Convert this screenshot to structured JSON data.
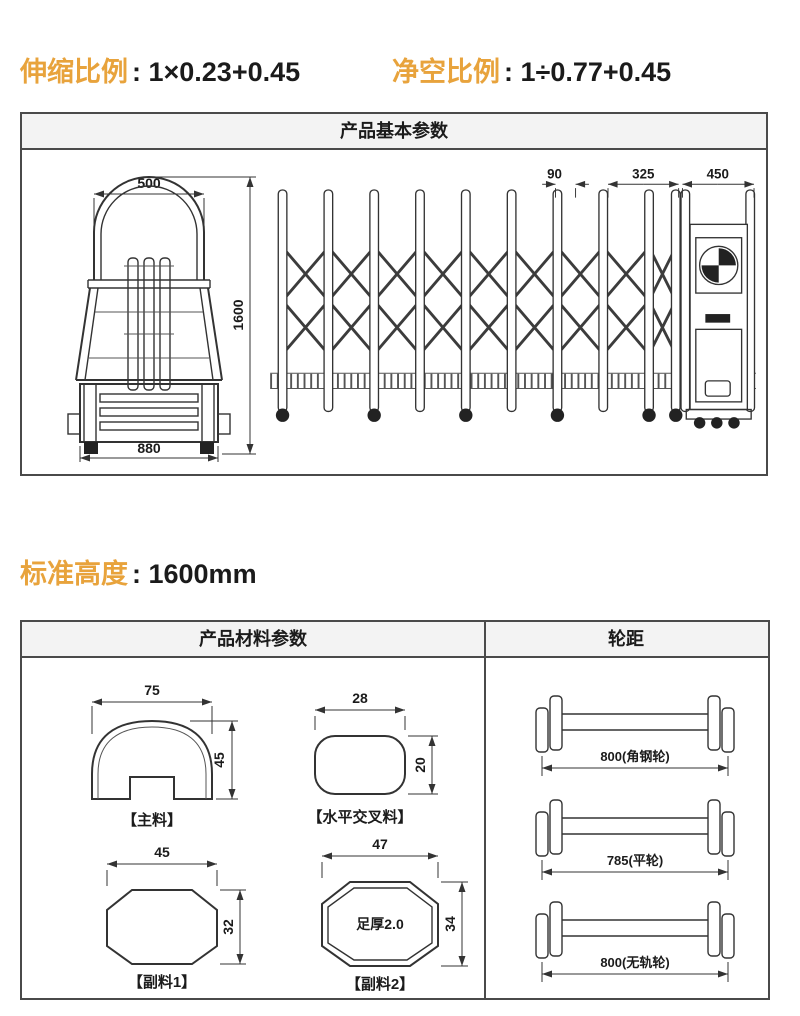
{
  "colors": {
    "accent_orange": "#E8A33C",
    "border_gray": "#4a4a4a",
    "header_bg": "#f3f3f3",
    "line": "#333333"
  },
  "ratios": {
    "stretch": {
      "label": "伸缩比例",
      "value": ": 1×0.23+0.45"
    },
    "clear": {
      "label": "净空比例",
      "value": ": 1÷0.77+0.45"
    }
  },
  "standard_height": {
    "label": "标准高度",
    "value": ": 1600mm"
  },
  "basic_box": {
    "title": "产品基本参数",
    "front_view": {
      "top_width": "500",
      "height": "1600",
      "base_width": "880"
    },
    "side_view": {
      "post_pitch": "90",
      "rear_span": "325",
      "motor_box_width": "450"
    }
  },
  "material_box": {
    "title": "产品材料参数",
    "profiles": [
      {
        "label": "【主料】",
        "w": "75",
        "h": "45"
      },
      {
        "label": "【水平交叉料】",
        "w": "28",
        "h": "20"
      },
      {
        "label": "【副料1】",
        "w": "45",
        "h": "32"
      },
      {
        "label": "【副料2】",
        "w": "47",
        "h": "34",
        "note": "足厚2.0"
      }
    ]
  },
  "wheel_box": {
    "title": "轮距",
    "tracks": [
      {
        "caption": "800(角钢轮)"
      },
      {
        "caption": "785(平轮)"
      },
      {
        "caption": "800(无轨轮)"
      }
    ]
  }
}
